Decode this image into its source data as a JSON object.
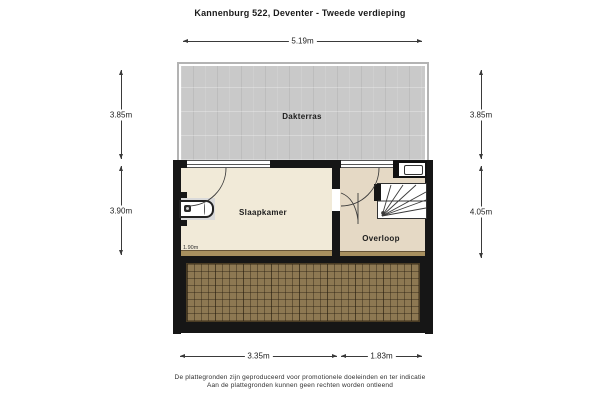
{
  "title": "Kannenburg 522, Deventer - Tweede verdieping",
  "rooms": {
    "terrace": "Dakterras",
    "bedroom": "Slaapkamer",
    "landing": "Overloop"
  },
  "dimensions": {
    "top": "5.19m",
    "left_upper": "3.85m",
    "left_lower": "3.90m",
    "right_upper": "3.85m",
    "right_lower": "4.05m",
    "bottom_left": "3.35m",
    "bottom_right": "1.83m",
    "ceiling_height": "1.90m"
  },
  "disclaimer": {
    "line1": "De plattegronden zijn geproduceerd voor promotionele doeleinden en ter indicatie",
    "line2": "Aan de plattegronden kunnen geen rechten worden ontleend"
  },
  "icons": {
    "stairs": "winder-stairs",
    "sink": "washbasin",
    "skylight": "roof-window",
    "door_arcs": "door-swing"
  },
  "colors": {
    "terrace": "#c9c9c9",
    "bedroom_floor": "#f1ead8",
    "landing_floor": "#e5d9c5",
    "roof": "#8d7852",
    "wall": "#161616",
    "dim": "#3a3a3a"
  }
}
